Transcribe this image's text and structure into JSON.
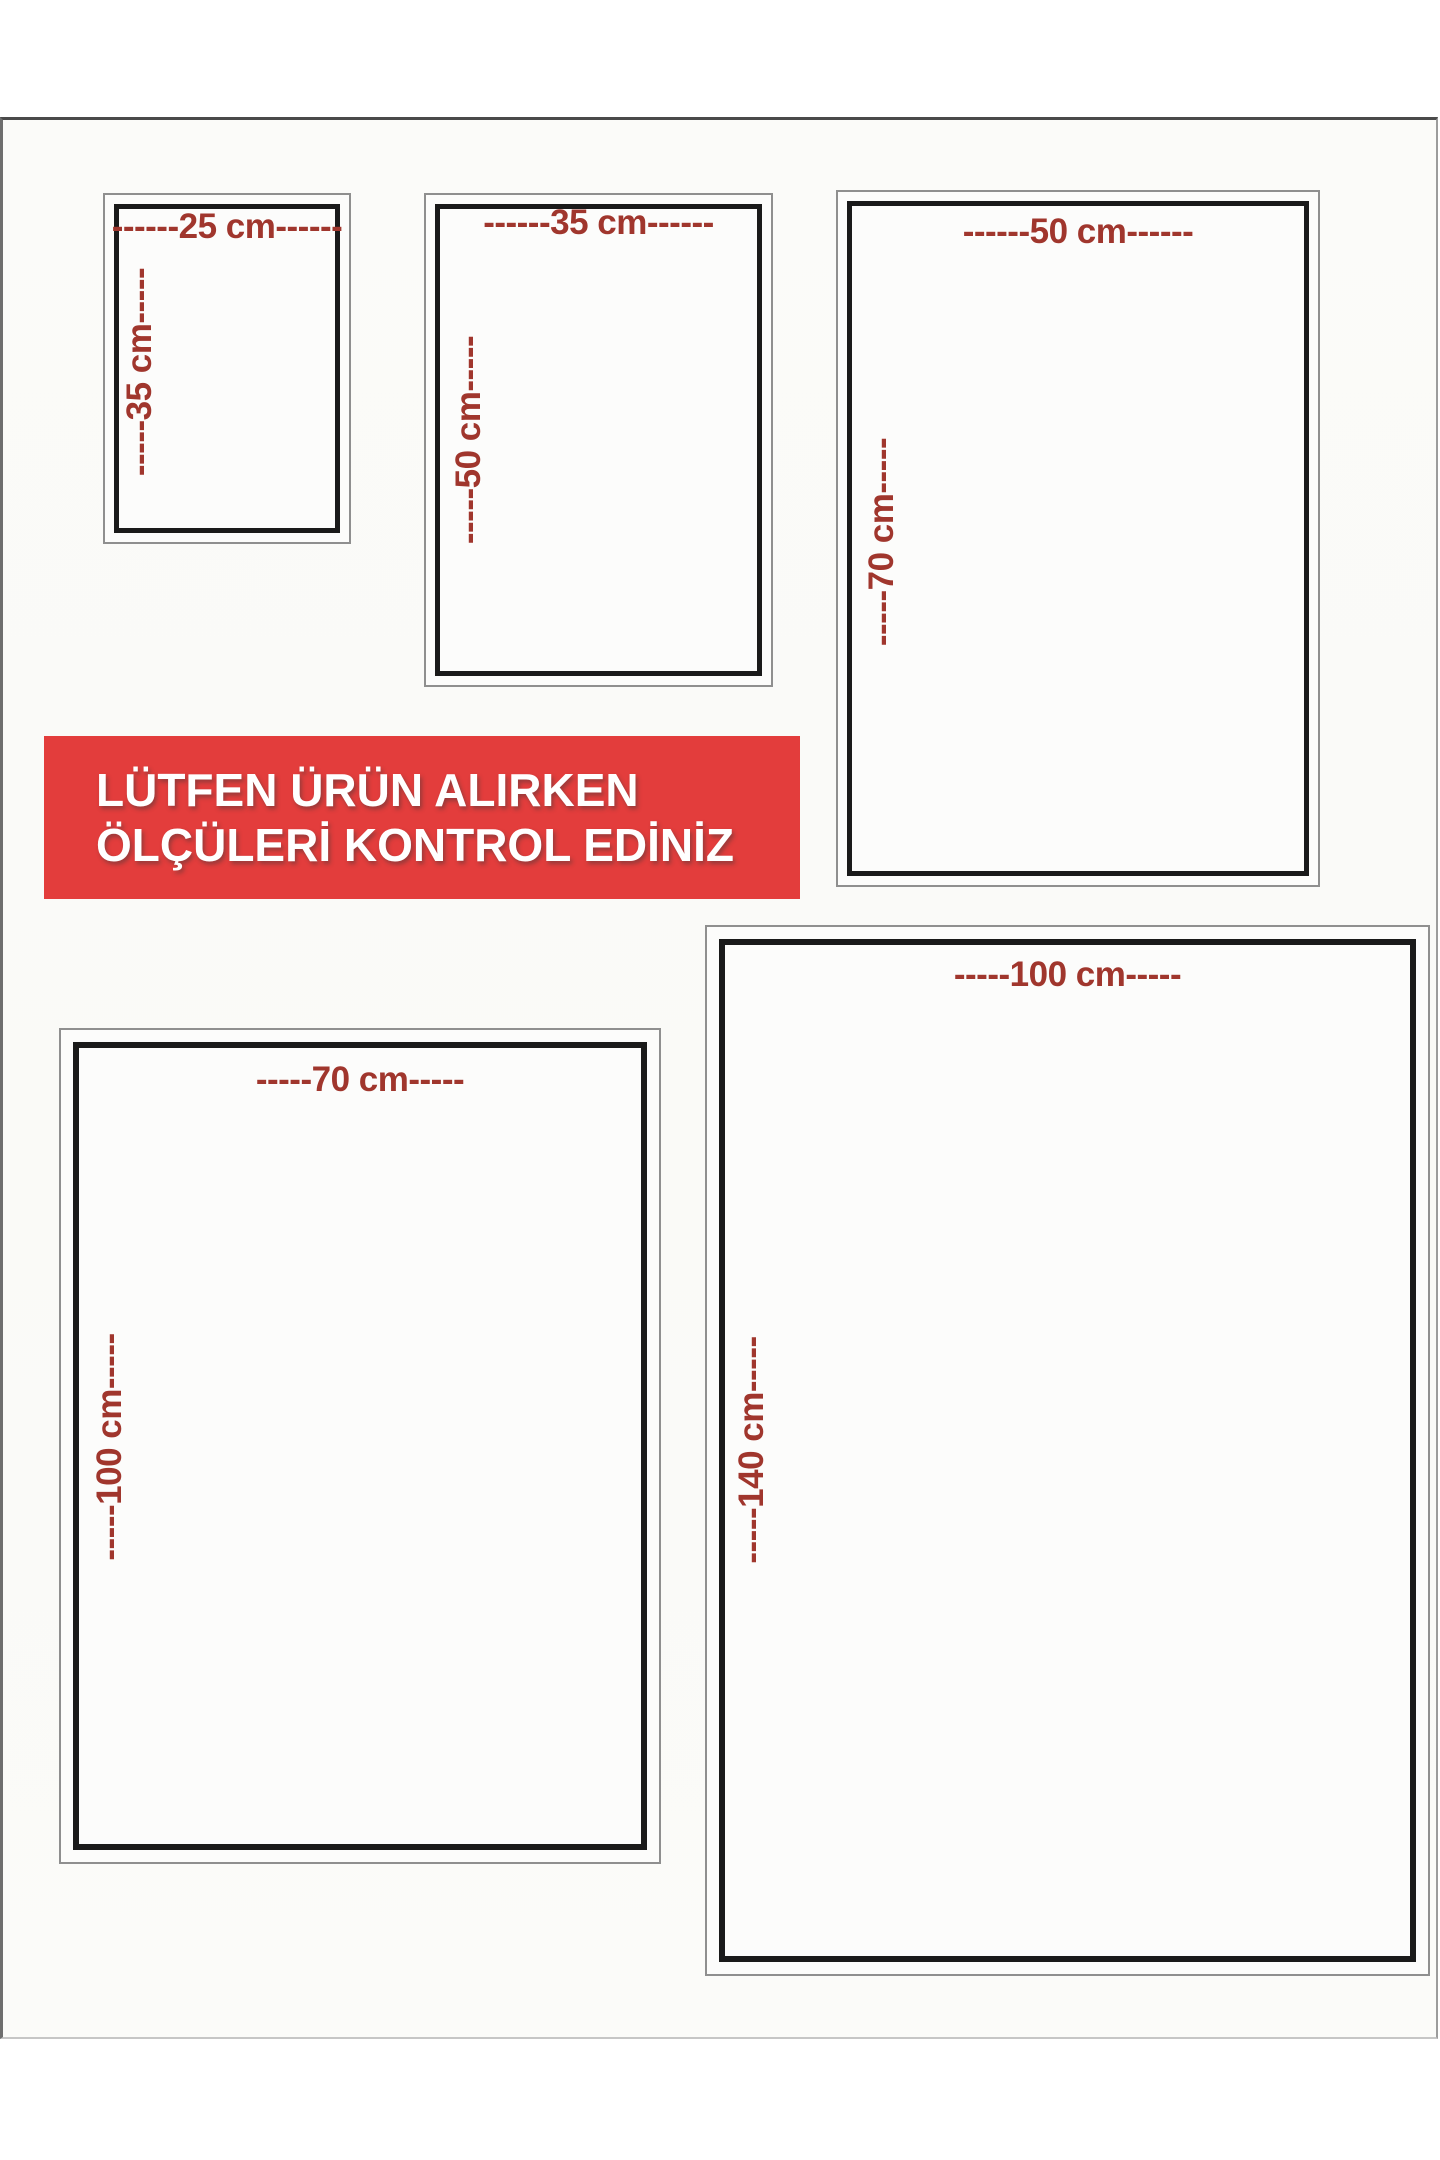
{
  "page": {
    "background": "#fbfbf9"
  },
  "banner": {
    "line1": "LÜTFEN ÜRÜN ALIRKEN",
    "line2": "ÖLÇÜLERİ KONTROL EDİNİZ",
    "background": "#e33d3c",
    "text_color": "#ffffff"
  },
  "colors": {
    "dimension_text": "#a0362d",
    "inner_frame_border": "#1a1a1a",
    "outer_frame_border": "#8f8f8f"
  },
  "sizes": [
    {
      "name": "25x35",
      "width_cm": 25,
      "height_cm": 35,
      "width_label": "------25 cm------",
      "height_label": "-----35 cm-----"
    },
    {
      "name": "35x50",
      "width_cm": 35,
      "height_cm": 50,
      "width_label": "------35 cm------",
      "height_label": "-----50 cm-----"
    },
    {
      "name": "50x70",
      "width_cm": 50,
      "height_cm": 70,
      "width_label": "------50 cm------",
      "height_label": "-----70 cm-----"
    },
    {
      "name": "70x100",
      "width_cm": 70,
      "height_cm": 100,
      "width_label": "-----70 cm-----",
      "height_label": "-----100 cm-----"
    },
    {
      "name": "100x140",
      "width_cm": 100,
      "height_cm": 140,
      "width_label": "-----100 cm-----",
      "height_label": "-----140 cm-----"
    }
  ]
}
